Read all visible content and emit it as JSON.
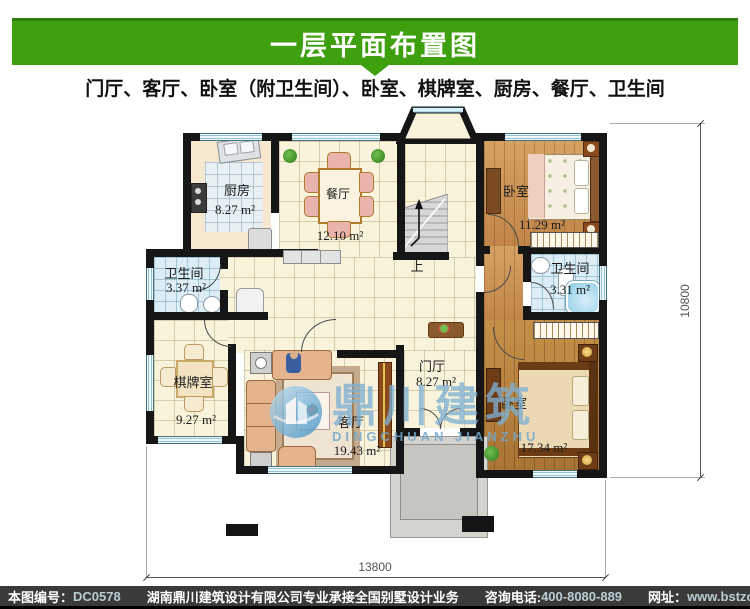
{
  "header": {
    "title": "一层平面布置图",
    "subtitle": "门厅、客厅、卧室（附卫生间）、卧室、棋牌室、厨房、餐厅、卫生间"
  },
  "rooms": {
    "kitchen": {
      "name": "厨房",
      "area": "8.27 m²"
    },
    "dining": {
      "name": "餐厅",
      "area": "12.10 m²"
    },
    "bedroom_top": {
      "name": "卧室",
      "area": "11.29 m²"
    },
    "bath_left": {
      "name": "卫生间",
      "area": "3.37 m²"
    },
    "bath_right": {
      "name": "卫生间",
      "area": "3.31 m²"
    },
    "chess": {
      "name": "棋牌室",
      "area": "9.27 m²"
    },
    "living": {
      "name": "客厅",
      "area": "19.43 m²"
    },
    "foyer": {
      "name": "门厅",
      "area": "8.27 m²"
    },
    "bedroom_bottom": {
      "name": "卧室",
      "area": "17.34 m²"
    }
  },
  "plan": {
    "stairs_up_label": "上",
    "dim_width": "13800",
    "dim_height": "10800"
  },
  "watermark": {
    "cn": "鼎川建筑",
    "en": "DINGCHUAN JIANZHU"
  },
  "footer": {
    "id_label": "本图编号：",
    "id_value": "DC0578",
    "company": "湖南鼎川建筑设计有限公司专业承接全国别墅设计业务",
    "phone_label": "咨询电话:",
    "phone_value": "400-8080-889",
    "web_label": "网址：",
    "web_value": "www.bstzcs.com"
  },
  "colors": {
    "header_green": "#3ea00f",
    "footer_bg": "#3a3a3a",
    "watermark_blue": "#7fb0d4"
  }
}
